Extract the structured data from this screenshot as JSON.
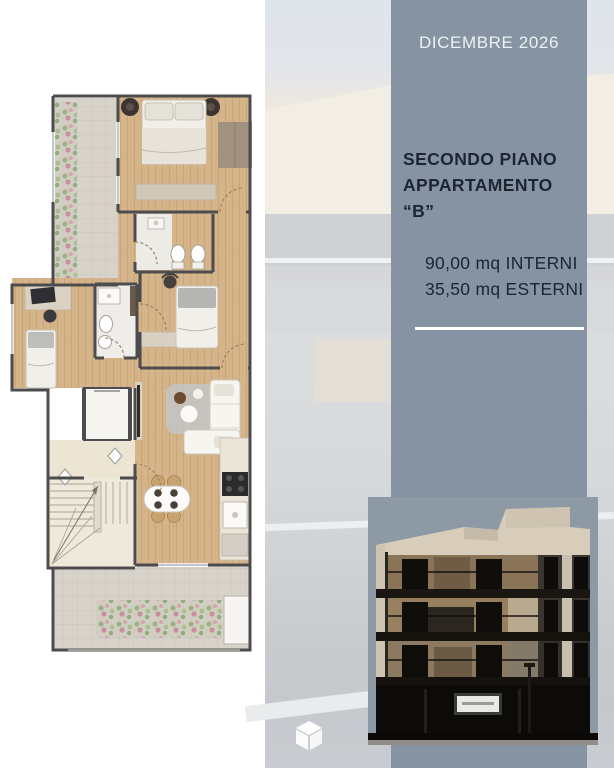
{
  "panel": {
    "date": "DICEMBRE 2026",
    "title_line1": "SECONDO PIANO",
    "title_line2": "APPARTAMENTO “B”",
    "area_interior": "90,00 mq INTERNI",
    "area_exterior": "35,50 mq ESTERNI"
  },
  "icons": {
    "cube": "cube-icon"
  },
  "colors": {
    "panel_bg": "#8593a2",
    "panel_title": "#1d2532",
    "panel_date": "#edf1f4",
    "divider": "#ffffff",
    "plan_wood": "#d6b48a",
    "plan_tile": "#d8d3ca",
    "plan_wall": "#4c4c4e",
    "photo_sky": "#8d99a5",
    "photo_dark": "#14110e",
    "photo_cream": "#d8cdbb"
  }
}
